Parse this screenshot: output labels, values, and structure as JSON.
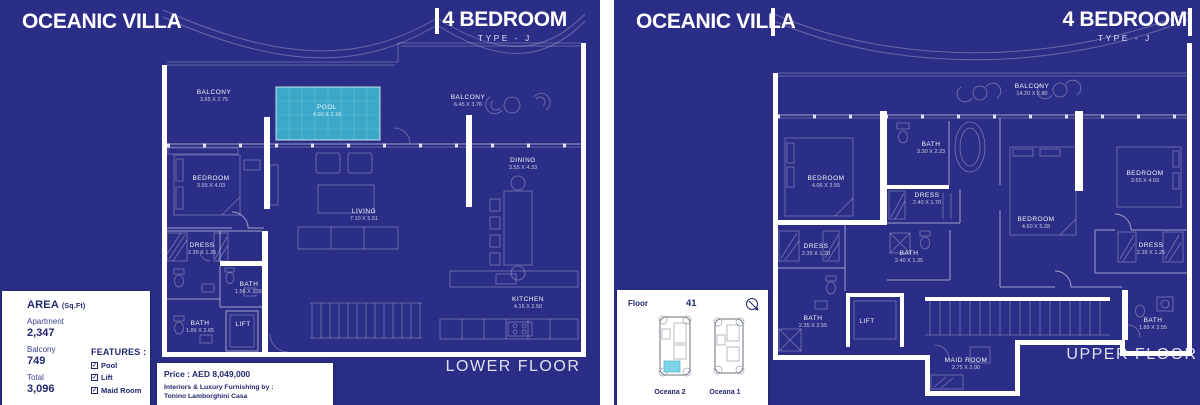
{
  "palette": {
    "panel_bg": "#2b2e87",
    "pool_fill": "#3aa9c9",
    "ink": "#23276f",
    "wall": "#ffffff",
    "key_highlight": "#7fd4e8"
  },
  "lower": {
    "title": "OCEANIC VILLA",
    "type_heading": "4 BEDROOM",
    "type_sub": "TYPE - J",
    "floor_label": "LOWER FLOOR",
    "rooms": [
      {
        "name": "BALCONY",
        "dims": "3.65 X 2.75"
      },
      {
        "name": "POOL",
        "dims": "4.00 X 2.18"
      },
      {
        "name": "BALCONY",
        "dims": "6.45 X 3.76"
      },
      {
        "name": "BEDROOM",
        "dims": "3.55 X 4.03"
      },
      {
        "name": "LIVING",
        "dims": "7.10 X 5.51"
      },
      {
        "name": "DINING",
        "dims": "3.55 X 4.33"
      },
      {
        "name": "DRESS",
        "dims": "2.35 X 1.35"
      },
      {
        "name": "BATH",
        "dims": "1.56 X 2.50"
      },
      {
        "name": "BATH",
        "dims": "1.89 X 2.65"
      },
      {
        "name": "LIFT",
        "dims": ""
      },
      {
        "name": "KITCHEN",
        "dims": "4.16 X 2.50"
      }
    ]
  },
  "upper": {
    "title": "OCEANIC VILLA",
    "type_heading": "4 BEDROOM",
    "type_sub": "TYPE - J",
    "floor_label": "UPPER FLOOR",
    "rooms": [
      {
        "name": "BALCONY",
        "dims": "14.20 X 2.80"
      },
      {
        "name": "BATH",
        "dims": "3.30 X 2.23"
      },
      {
        "name": "BEDROOM",
        "dims": "4.06 X 3.55"
      },
      {
        "name": "DRESS",
        "dims": "2.40 X 1.70"
      },
      {
        "name": "BEDROOM",
        "dims": "4.60 X 5.28"
      },
      {
        "name": "BEDROOM",
        "dims": "3.55 X 4.03"
      },
      {
        "name": "DRESS",
        "dims": "2.35 X 1.25"
      },
      {
        "name": "DRESS",
        "dims": "2.35 X 1.20"
      },
      {
        "name": "BATH",
        "dims": "2.40 X 1.35"
      },
      {
        "name": "BATH",
        "dims": "2.35 X 2.55"
      },
      {
        "name": "LIFT",
        "dims": ""
      },
      {
        "name": "BATH",
        "dims": "1.89 X 2.55"
      },
      {
        "name": "MAID ROOM",
        "dims": "2.75 X 2.00"
      }
    ]
  },
  "area_panel": {
    "heading": "AREA",
    "unit": "(Sq.Ft)",
    "rows": [
      {
        "label": "Apartment",
        "value": "2,347"
      },
      {
        "label": "Balcony",
        "value": "749"
      },
      {
        "label": "Total",
        "value": "3,096"
      }
    ],
    "features_heading": "FEATURES :",
    "features": [
      {
        "label": "Pool"
      },
      {
        "label": "Lift"
      },
      {
        "label": "Maid Room"
      }
    ],
    "check_glyph": "✓"
  },
  "price_panel": {
    "price": "Price : AED 8,049,000",
    "furnishing_label": "Interiors & Luxury Furnishing by :",
    "furnishing_value": "Tonino Lamborghini Casa"
  },
  "floor_panel": {
    "label": "Floor",
    "number": "41",
    "buildings": [
      {
        "name": "Oceana 2"
      },
      {
        "name": "Oceana 1"
      }
    ]
  }
}
